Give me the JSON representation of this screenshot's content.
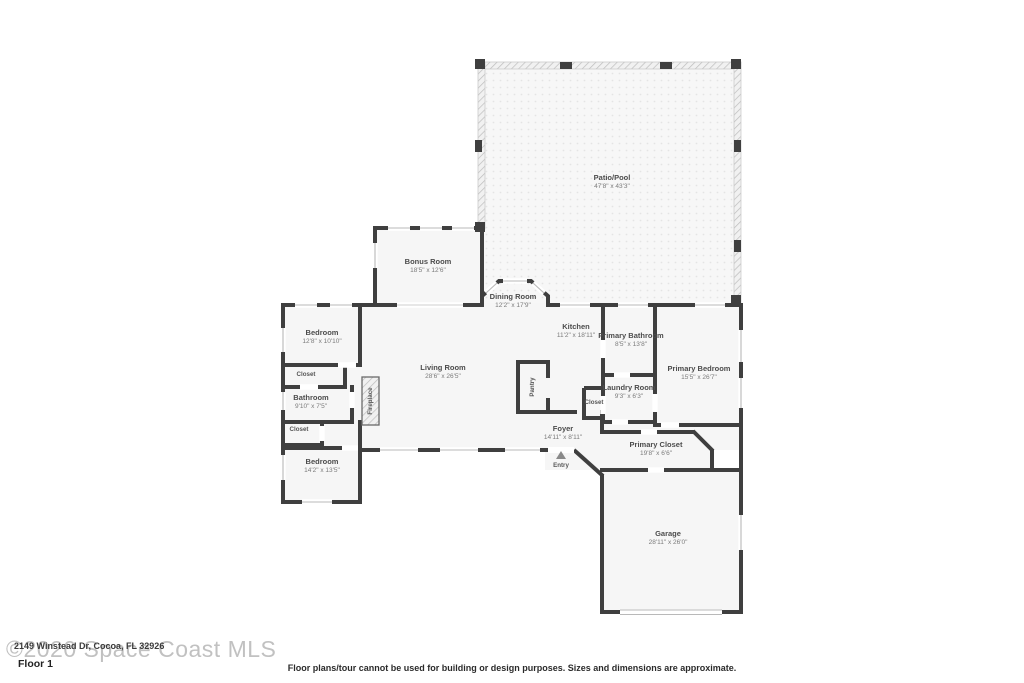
{
  "floorplan": {
    "colors": {
      "wall": "#3f3f3f",
      "floor": "#f6f6f6",
      "hatch_line": "#bdbdbd",
      "window_line": "#b9b9b9"
    },
    "rooms": [
      {
        "name": "Patio/Pool",
        "dims": "47'8\" x 43'3\""
      },
      {
        "name": "Bonus Room",
        "dims": "18'5\" x 12'6\""
      },
      {
        "name": "Dining Room",
        "dims": "12'2\" x 17'9\""
      },
      {
        "name": "Kitchen",
        "dims": "11'2\" x 18'11\""
      },
      {
        "name": "Primary Bathroom",
        "dims": "8'5\" x 13'8\""
      },
      {
        "name": "Primary Bedroom",
        "dims": "15'5\" x 26'7\""
      },
      {
        "name": "Living Room",
        "dims": "28'6\" x 26'5\""
      },
      {
        "name": "Bedroom",
        "dims": "12'8\" x 10'10\""
      },
      {
        "name": "Closet",
        "dims": ""
      },
      {
        "name": "Bathroom",
        "dims": "9'10\" x 7'5\""
      },
      {
        "name": "Closet",
        "dims": ""
      },
      {
        "name": "Bedroom",
        "dims": "14'2\" x 13'5\""
      },
      {
        "name": "Fireplace",
        "dims": ""
      },
      {
        "name": "Pantry",
        "dims": ""
      },
      {
        "name": "Laundry Room",
        "dims": "9'3\" x 6'3\""
      },
      {
        "name": "Closet",
        "dims": ""
      },
      {
        "name": "Foyer",
        "dims": "14'11\" x 8'11\""
      },
      {
        "name": "Entry",
        "dims": ""
      },
      {
        "name": "Primary Closet",
        "dims": "19'8\" x 6'6\""
      },
      {
        "name": "Garage",
        "dims": "28'11\" x 26'0\""
      }
    ],
    "footer": {
      "watermark": "©2020 Space Coast MLS",
      "address": "2149 Winstead Dr, Cocoa, FL 32926",
      "floor_label": "Floor 1",
      "disclaimer": "Floor plans/tour cannot be used for building or design purposes. Sizes and dimensions are approximate."
    }
  }
}
